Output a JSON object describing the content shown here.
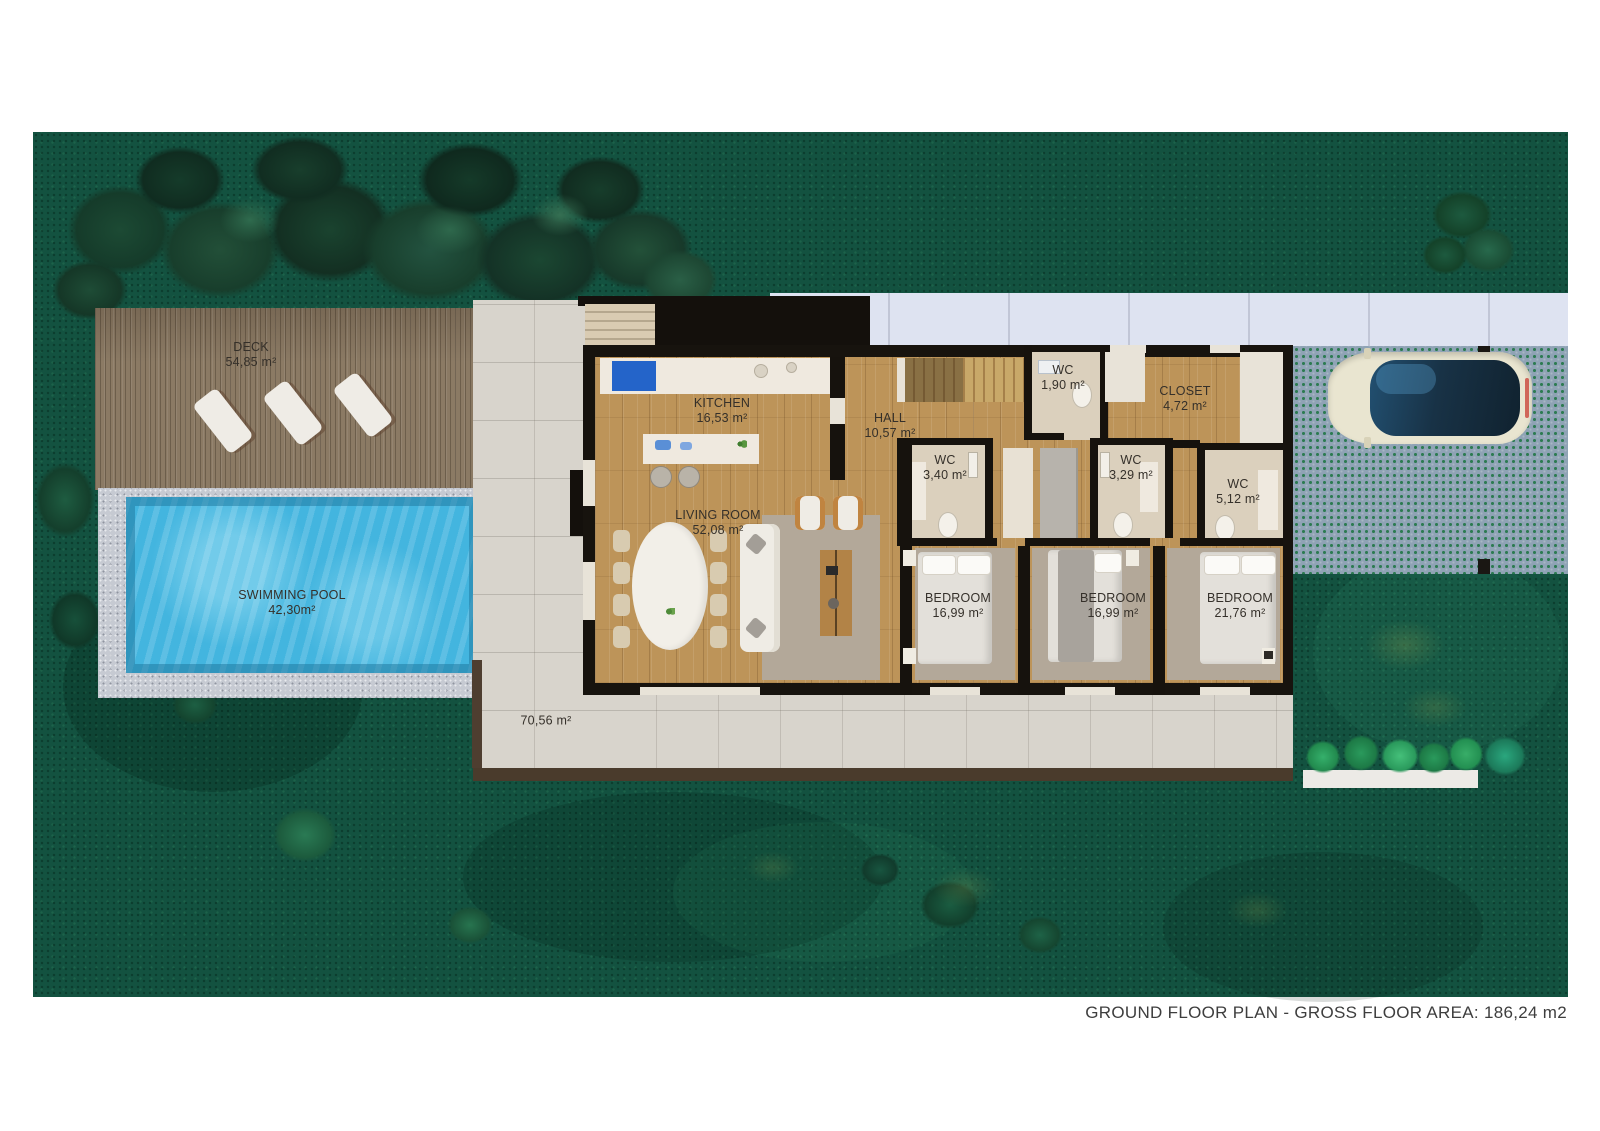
{
  "caption": "GROUND FLOOR PLAN - GROSS FLOOR AREA: 186,24 m2",
  "rooms": {
    "deck": {
      "name": "DECK",
      "area": "54,85 m²"
    },
    "pool": {
      "name": "SWIMMING POOL",
      "area": "42,30m²"
    },
    "kitchen": {
      "name": "KITCHEN",
      "area": "16,53 m²"
    },
    "living": {
      "name": "LIVING ROOM",
      "area": "52,08 m²"
    },
    "hall": {
      "name": "HALL",
      "area": "10,57 m²"
    },
    "wc_hall": {
      "name": "WC",
      "area": "1,90 m²"
    },
    "closet": {
      "name": "CLOSET",
      "area": "4,72 m²"
    },
    "wc_1": {
      "name": "WC",
      "area": "3,40 m²"
    },
    "wc_2": {
      "name": "WC",
      "area": "3,29 m²"
    },
    "wc_3": {
      "name": "WC",
      "area": "5,12 m²"
    },
    "bedroom_1": {
      "name": "BEDROOM",
      "area": "16,99 m²"
    },
    "bedroom_2": {
      "name": "BEDROOM",
      "area": "16,99 m²"
    },
    "bedroom_3": {
      "name": "BEDROOM",
      "area": "21,76 m²"
    },
    "terrace": {
      "area": "70,56 m²"
    }
  },
  "palette": {
    "grass": "#135240",
    "pool_water": "#43b5df",
    "wood_floor": "#bd9459",
    "deck_wood": "#8b7a64",
    "driveway_pavers": "#8fa3b5",
    "walkway": "#dee3f1",
    "terrace_stone": "#d8d4cc",
    "wall_black": "#16120d",
    "car_body": "#e9e5d0",
    "car_glass": "#183246",
    "planter_green": "#35b06b",
    "label_text": "#35302a",
    "caption_text": "#3e3e3e"
  }
}
